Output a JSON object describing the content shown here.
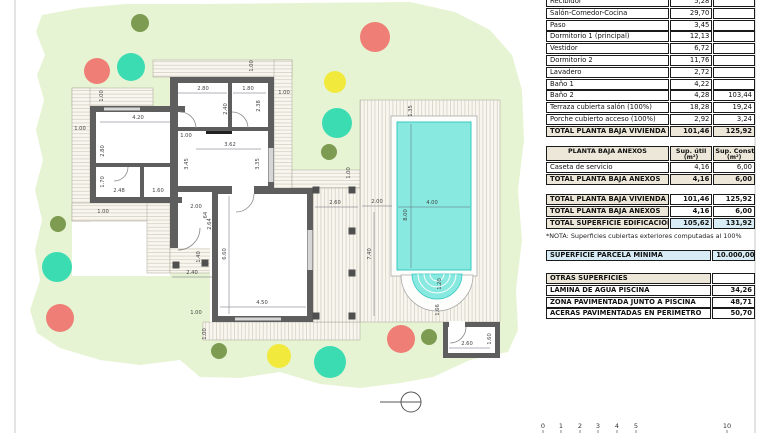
{
  "plan": {
    "colors": {
      "garden": "#e6f4d3",
      "deck": "#f8f6ef",
      "hatch": "#ccc6b6",
      "wall": "#5e5e5e",
      "pool": "#87e9e0",
      "pool_edge": "#38c9c1",
      "red": "#ef7f76",
      "teal": "#3cdcb3",
      "yellow": "#f1e93c",
      "olive": "#7d9b51",
      "dim_text": "#444444"
    },
    "garden_points": "42,15 80,8 125,4 200,4 300,3 410,2 455,12 490,30 512,55 522,90 524,140 518,190 522,240 516,290 518,330 508,352 470,360 433,377 400,383 360,388 320,384 280,372 240,378 200,377 180,360 140,365 100,360 60,348 37,333 30,310 40,280 35,250 42,220 35,190 43,160 36,130 44,100 37,75 45,55 36,32",
    "trees": [
      [
        140,
        23,
        9,
        "olive"
      ],
      [
        97,
        71,
        13,
        "red"
      ],
      [
        131,
        67,
        14,
        "teal"
      ],
      [
        375,
        37,
        15,
        "red"
      ],
      [
        335,
        82,
        11,
        "yellow"
      ],
      [
        337,
        123,
        15,
        "teal"
      ],
      [
        329,
        152,
        8,
        "olive"
      ],
      [
        58,
        224,
        8,
        "olive"
      ],
      [
        57,
        267,
        15,
        "teal"
      ],
      [
        60,
        318,
        14,
        "red"
      ],
      [
        219,
        351,
        8,
        "olive"
      ],
      [
        279,
        356,
        12,
        "yellow"
      ],
      [
        330,
        362,
        16,
        "teal"
      ],
      [
        401,
        339,
        14,
        "red"
      ],
      [
        429,
        337,
        8,
        "olive"
      ]
    ],
    "columns": [
      [
        316,
        190
      ],
      [
        352,
        190
      ],
      [
        352,
        231
      ],
      [
        352,
        273
      ],
      [
        316,
        316
      ],
      [
        352,
        316
      ],
      [
        176,
        265
      ],
      [
        205,
        263
      ]
    ],
    "dims": [
      {
        "t": "1.00",
        "x": 103,
        "y": 96,
        "v": 1
      },
      {
        "t": "1.00",
        "x": 80,
        "y": 130
      },
      {
        "t": "4.20",
        "x": 138,
        "y": 119,
        "l": [
          100,
          122,
          172,
          122
        ]
      },
      {
        "t": "2.80",
        "x": 104,
        "y": 151,
        "v": 1
      },
      {
        "t": "1.70",
        "x": 104,
        "y": 182,
        "v": 1
      },
      {
        "t": "2.48",
        "x": 119,
        "y": 192
      },
      {
        "t": "1.60",
        "x": 158,
        "y": 192
      },
      {
        "t": "1.00",
        "x": 103,
        "y": 213
      },
      {
        "t": "2.80",
        "x": 203,
        "y": 90,
        "l": [
          178,
          93,
          227,
          93
        ]
      },
      {
        "t": "1.80",
        "x": 248,
        "y": 90,
        "l": [
          233,
          93,
          266,
          93
        ]
      },
      {
        "t": "1.00",
        "x": 284,
        "y": 94
      },
      {
        "t": "1.00",
        "x": 253,
        "y": 66,
        "v": 1
      },
      {
        "t": "2.40",
        "x": 227,
        "y": 109,
        "v": 1
      },
      {
        "t": "2.38",
        "x": 260,
        "y": 106,
        "v": 1
      },
      {
        "t": "1.00",
        "x": 186,
        "y": 137
      },
      {
        "t": "3.62",
        "x": 230,
        "y": 146,
        "l": [
          196,
          149,
          261,
          149
        ]
      },
      {
        "t": "3.45",
        "x": 188,
        "y": 164,
        "v": 1
      },
      {
        "t": "3.35",
        "x": 259,
        "y": 164,
        "v": 1
      },
      {
        "t": "2.00",
        "x": 196,
        "y": 208
      },
      {
        "t": ".64",
        "x": 207,
        "y": 216,
        "v": 1
      },
      {
        "t": "2.64",
        "x": 211,
        "y": 224,
        "v": 1
      },
      {
        "t": "1.40",
        "x": 200,
        "y": 257,
        "v": 1
      },
      {
        "t": "2.40",
        "x": 192,
        "y": 274,
        "l": [
          172,
          277,
          212,
          277
        ]
      },
      {
        "t": "6.60",
        "x": 226,
        "y": 254,
        "v": 1,
        "l": [
          229,
          196,
          229,
          314
        ]
      },
      {
        "t": "4.50",
        "x": 262,
        "y": 304,
        "l": [
          220,
          307,
          306,
          307
        ]
      },
      {
        "t": "1.00",
        "x": 196,
        "y": 314
      },
      {
        "t": "1.00",
        "x": 206,
        "y": 334,
        "v": 1
      },
      {
        "t": "2.60",
        "x": 335,
        "y": 204,
        "l": [
          315,
          207,
          358,
          207
        ]
      },
      {
        "t": "2.00",
        "x": 377,
        "y": 203,
        "l": [
          362,
          206,
          392,
          206
        ]
      },
      {
        "t": "7.40",
        "x": 371,
        "y": 254,
        "v": 1,
        "l": [
          374,
          212,
          374,
          316
        ]
      },
      {
        "t": "1.00",
        "x": 350,
        "y": 173,
        "v": 1
      },
      {
        "t": "1.35",
        "x": 412,
        "y": 111,
        "v": 1
      },
      {
        "t": "4.00",
        "x": 432,
        "y": 204,
        "l": [
          398,
          207,
          470,
          207
        ]
      },
      {
        "t": "8.00",
        "x": 407,
        "y": 215,
        "v": 1,
        "l": [
          411,
          124,
          411,
          268
        ]
      },
      {
        "t": "1.20",
        "x": 441,
        "y": 284,
        "v": 1
      },
      {
        "t": "1.66",
        "x": 439,
        "y": 310,
        "v": 1
      },
      {
        "t": "2.60",
        "x": 467,
        "y": 345,
        "l": [
          449,
          348,
          490,
          348
        ]
      },
      {
        "t": "1.60",
        "x": 491,
        "y": 339,
        "v": 1
      }
    ],
    "scale_bar": {
      "labels": [
        "0",
        "1",
        "2",
        "3",
        "4",
        "5",
        "10"
      ],
      "x": [
        543,
        561,
        580,
        598,
        617,
        636,
        727
      ],
      "y": 427
    }
  },
  "table": {
    "vivienda_rows": [
      [
        "Recibidor",
        "5,28",
        ""
      ],
      [
        "Salón-Comedor-Cocina",
        "29,70",
        ""
      ],
      [
        "Paso",
        "3,45",
        ""
      ],
      [
        "Dormitorio 1 (principal)",
        "12,13",
        ""
      ],
      [
        "Vestidor",
        "6,72",
        ""
      ],
      [
        "Dormitorio 2",
        "11,76",
        ""
      ],
      [
        "Lavadero",
        "2,72",
        ""
      ],
      [
        "Baño 1",
        "4,22",
        ""
      ],
      [
        "Baño 2",
        "4,28",
        "103,44"
      ],
      [
        "Terraza cubierta salón (100%)",
        "18,28",
        "19,24"
      ],
      [
        "Porche cubierto acceso (100%)",
        "2,92",
        "3,24"
      ]
    ],
    "vivienda_total": [
      "TOTAL PLANTA BAJA VIVIENDA",
      "101,46",
      "125,92"
    ],
    "anexos_header": [
      [
        "PLANTA BAJA ANEXOS"
      ],
      [
        "Sup. útil",
        "(m²)"
      ],
      [
        "Sup. Const.",
        "(m²)"
      ]
    ],
    "anexos_rows": [
      [
        "Caseta de servicio",
        "4,16",
        "6,00"
      ]
    ],
    "anexos_total": [
      "TOTAL PLANTA BAJA ANEXOS",
      "4,16",
      "6,00"
    ],
    "summary_rows": [
      [
        "TOTAL PLANTA BAJA VIVIENDA",
        "101,46",
        "125,92"
      ],
      [
        "TOTAL PLANTA BAJA ANEXOS",
        "4,16",
        "6,00"
      ],
      [
        "TOTAL SUPERFICIE EDIFICACIÓN",
        "105,62",
        "131,92"
      ]
    ],
    "note": "*NOTA: Superficies cubiertas exteriores computadas al 100%",
    "parcela_row": [
      "SUPERFICIE PARCELA MÍNIMA",
      "10.000,00"
    ],
    "otras_header": "OTRAS SUPERFICIES",
    "otras_rows": [
      [
        "LÁMINA DE AGUA PISCINA",
        "34,26"
      ],
      [
        "ZONA PAVIMENTADA JUNTO A PISCINA",
        "48,71"
      ],
      [
        "ACERAS PAVIMENTADAS EN PERÍMETRO",
        "50,70"
      ]
    ]
  }
}
